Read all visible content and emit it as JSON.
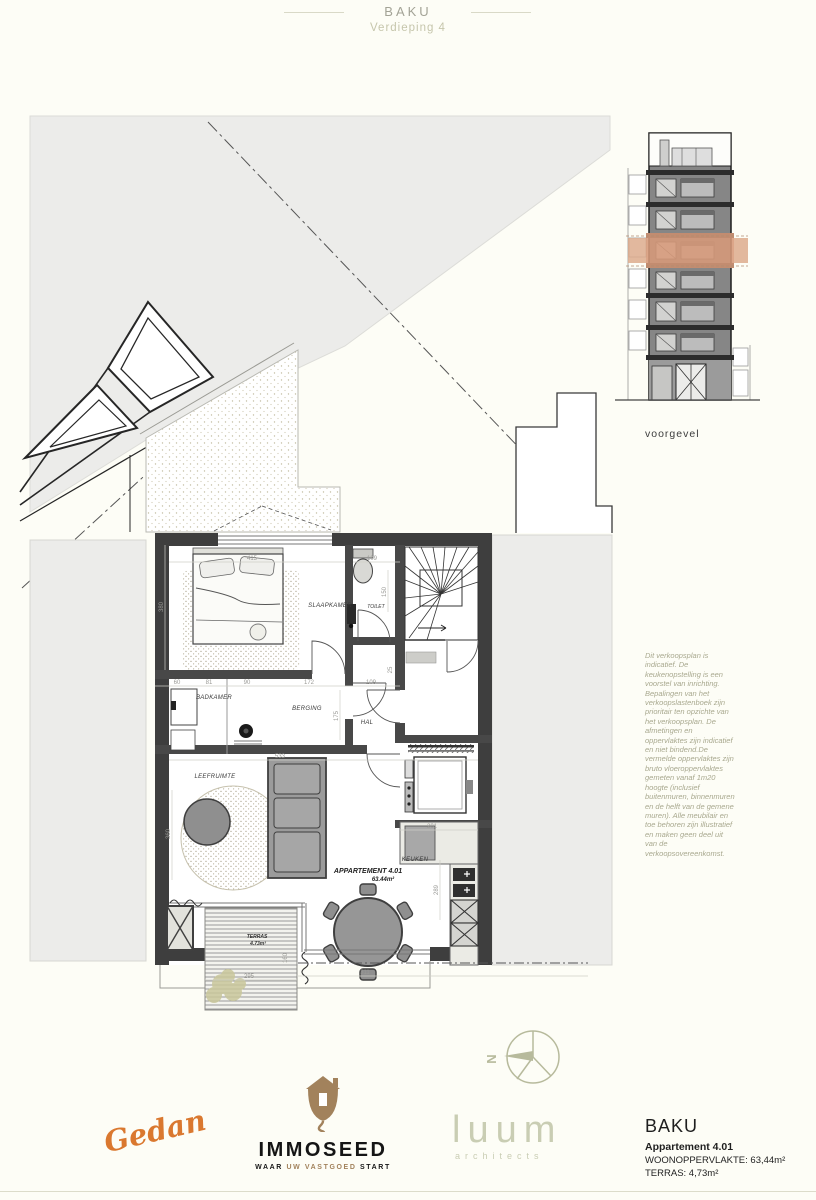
{
  "header": {
    "title": "BAKU",
    "subtitle": "Verdieping 4"
  },
  "plan": {
    "rooms": {
      "slaapkamer": "SLAAPKAMER",
      "toilet": "TOILET",
      "badkamer": "BADKAMER",
      "berging": "BERGING",
      "hal": "HAL",
      "leefruimte": "LEEFRUIMTE",
      "keuken": "KEUKEN"
    },
    "apartment": {
      "label": "APPARTEMENT 4.01",
      "area": "63.44m²"
    },
    "terras": {
      "label": "TERRAS",
      "area": "4.73m²"
    },
    "dims": {
      "w415": "415",
      "w380": "380",
      "w109a": "109",
      "w150": "150",
      "w60": "60",
      "w81": "81",
      "w90": "90",
      "w172": "172",
      "w109b": "109",
      "w25": "25",
      "w175": "175",
      "w533": "533",
      "w360": "360",
      "w201": "201",
      "w289": "289",
      "w295": "295",
      "w311": "311",
      "w160": "160"
    }
  },
  "elevation": {
    "caption": "voorgevel"
  },
  "compass": {
    "north": "N"
  },
  "legal": {
    "disclaimer": "Dit verkoopsplan is indicatief. De keukenopstelling is een voorstel van inrichting.  Bepalingen van het verkoopslastenboek zijn prioritair ten opzichte van het verkoopsplan. De afmetingen  en oppervlaktes zijn indicatief en niet bindend.De vermelde oppervlaktes zijn bruto vloeroppervlaktes gemeten vanaf 1m20 hoogte (inclusief buitenmuren, binnenmuren en de helft van de gemene muren). Alle meubilair en toe behoren zijn illustratief en maken geen deel uit van de verkoopsovereenkomst."
  },
  "footer": {
    "gedan": "Gedan",
    "immoseed": {
      "name": "IMMOSEED",
      "tag1": "WAAR",
      "tag2": "UW VASTGOED",
      "tag3": "START"
    },
    "luum": {
      "name": "luum",
      "sub": "architects"
    },
    "info": {
      "project": "BAKU",
      "unit": "Appartement 4.01",
      "living": "WOONOPPERVLAKTE: 63,44m²",
      "terrace": "TERRAS: 4,73m²"
    }
  },
  "colors": {
    "highlight_orange": "#d79a7a",
    "logo_orange": "#da782f",
    "logo_brown": "#a2825c",
    "sage": "#c9cdb3",
    "olive_text": "#a8a88e",
    "wall_dark": "#3e3e3e"
  }
}
